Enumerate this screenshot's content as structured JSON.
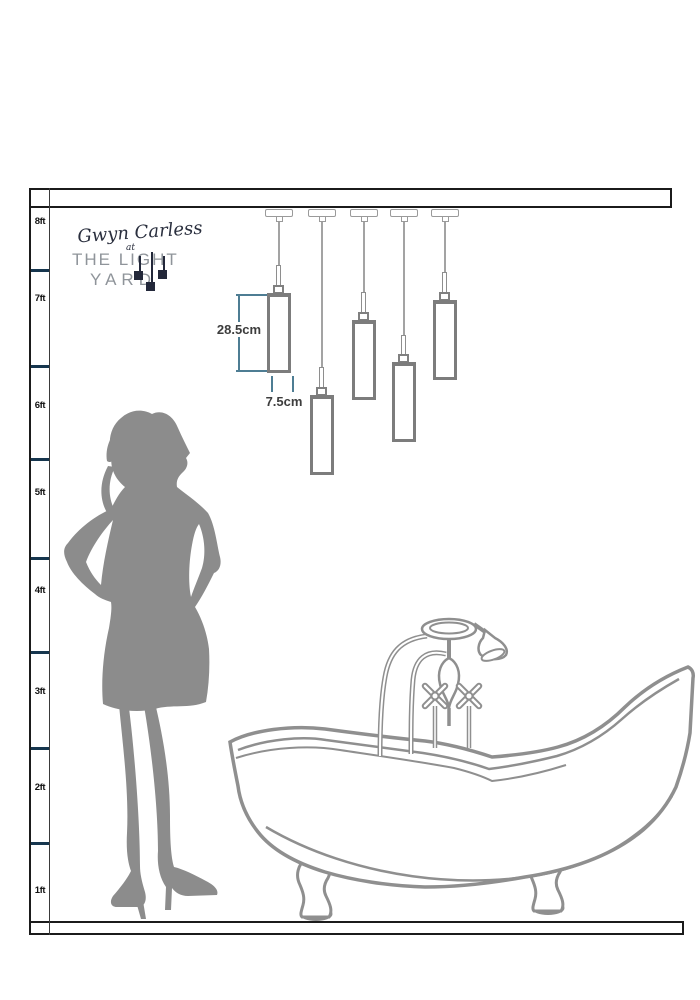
{
  "page": {
    "description": "Scale diagram: five-drop glass tube pendant cluster hung above a clawfoot bathtub, with female silhouette and foot-ruler for height reference",
    "background": "#ffffff"
  },
  "brand": {
    "script_name": "Gwyn Carless",
    "at_word": "at",
    "name_line1": "THE LIGHT",
    "name_line2": "YARD"
  },
  "ruler": {
    "unit_labels": [
      "8ft",
      "7ft",
      "6ft",
      "5ft",
      "4ft",
      "3ft",
      "2ft",
      "1ft"
    ]
  },
  "annotations": {
    "shade_height_label": "28.5cm",
    "shade_width_label": "7.5cm"
  },
  "scene": {
    "pendant_count": 5,
    "objects": [
      "ceiling bar",
      "five tube pendant lights on cables",
      "female silhouette",
      "clawfoot slipper bathtub with shower mixer",
      "floor bar"
    ]
  },
  "colors": {
    "frame_black": "#1b1b1b",
    "tick_navy": "#16364e",
    "dimension_teal": "#4e7d93",
    "line_art_gray": "#8f8f8f",
    "silhouette_gray": "#8c8c8c",
    "logo_ink": "#23283a",
    "logo_gray": "#8f949a"
  }
}
